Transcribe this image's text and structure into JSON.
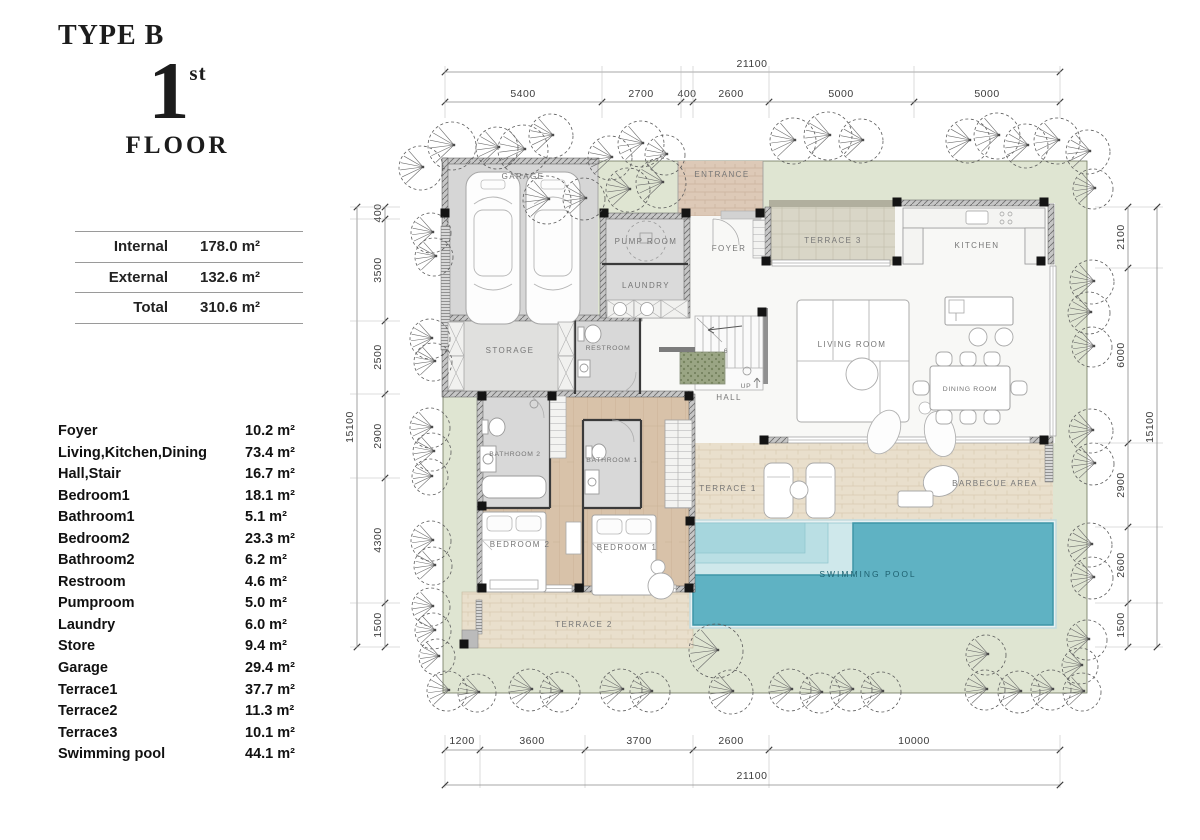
{
  "header": {
    "type_label": "TYPE B",
    "floor_number": "1",
    "floor_suffix": "st",
    "floor_word": "FLOOR"
  },
  "summary": {
    "rows": [
      {
        "label": "Internal",
        "value": "178.0 m²"
      },
      {
        "label": "External",
        "value": "132.6 m²"
      },
      {
        "label": "Total",
        "value": "310.6 m²"
      }
    ]
  },
  "areas": {
    "items": [
      {
        "name": "Foyer",
        "value": "10.2 m²"
      },
      {
        "name": "Living,Kitchen,Dining",
        "value": "73.4 m²"
      },
      {
        "name": "Hall,Stair",
        "value": "16.7 m²"
      },
      {
        "name": "Bedroom1",
        "value": "18.1 m²"
      },
      {
        "name": "Bathroom1",
        "value": "5.1 m²"
      },
      {
        "name": "Bedroom2",
        "value": "23.3 m²"
      },
      {
        "name": "Bathroom2",
        "value": "6.2 m²"
      },
      {
        "name": "Restroom",
        "value": "4.6 m²"
      },
      {
        "name": "Pumproom",
        "value": "5.0 m²"
      },
      {
        "name": "Laundry",
        "value": "6.0 m²"
      },
      {
        "name": "Store",
        "value": "9.4 m²"
      },
      {
        "name": "Garage",
        "value": "29.4 m²"
      },
      {
        "name": "Terrace1",
        "value": "37.7 m²"
      },
      {
        "name": "Terrace2",
        "value": "11.3 m²"
      },
      {
        "name": "Terrace3",
        "value": "10.1 m²"
      },
      {
        "name": "Swimming pool",
        "value": "44.1 m²"
      }
    ]
  },
  "plan": {
    "room_labels": {
      "garage": "GARAGE",
      "pump_room": "PUMP ROOM",
      "laundry": "LAUNDRY",
      "entrance": "ENTRANCE",
      "foyer": "FOYER",
      "terrace3": "TERRACE 3",
      "kitchen": "KITCHEN",
      "storage": "STORAGE",
      "restroom": "RESTROOM",
      "hall": "HALL",
      "up": "UP",
      "stair_steps": "6",
      "living": "LIVING ROOM",
      "dining": "DINING ROOM",
      "bathroom2": "BATHROOM 2",
      "bathroom1": "BATHROOM 1",
      "bedroom2": "BEDROOM 2",
      "bedroom1": "BEDROOM 1",
      "terrace1": "TERRACE 1",
      "barbecue": "BARBECUE AREA",
      "terrace2": "TERRACE 2",
      "pool": "SWIMMING POOL"
    },
    "dimensions": {
      "top": {
        "total": "21100",
        "segments": [
          "5400",
          "2700",
          "400",
          "2600",
          "5000",
          "5000"
        ]
      },
      "bottom": {
        "total": "21100",
        "segments": [
          "1200",
          "3600",
          "3700",
          "2600",
          "10000"
        ]
      },
      "left": {
        "total": "15100",
        "segments": [
          "400",
          "3500",
          "2500",
          "2900",
          "4300",
          "1500"
        ]
      },
      "right": {
        "total": "15100",
        "segments": [
          "2100",
          "6000",
          "2900",
          "2600",
          "1500"
        ]
      }
    },
    "colors": {
      "plot_green": "#dfe5d2",
      "pool_teal": "#5fb2c3",
      "pool_edge": "#3e96a8",
      "wood_floor": "#d8c2a9",
      "terrace_beige": "#e9dfcc",
      "entrance_brick": "#ddc9b7",
      "gray_room": "#d8d8d8",
      "white_floor": "#f8f8f6",
      "wall": "#3a3a3a"
    }
  }
}
